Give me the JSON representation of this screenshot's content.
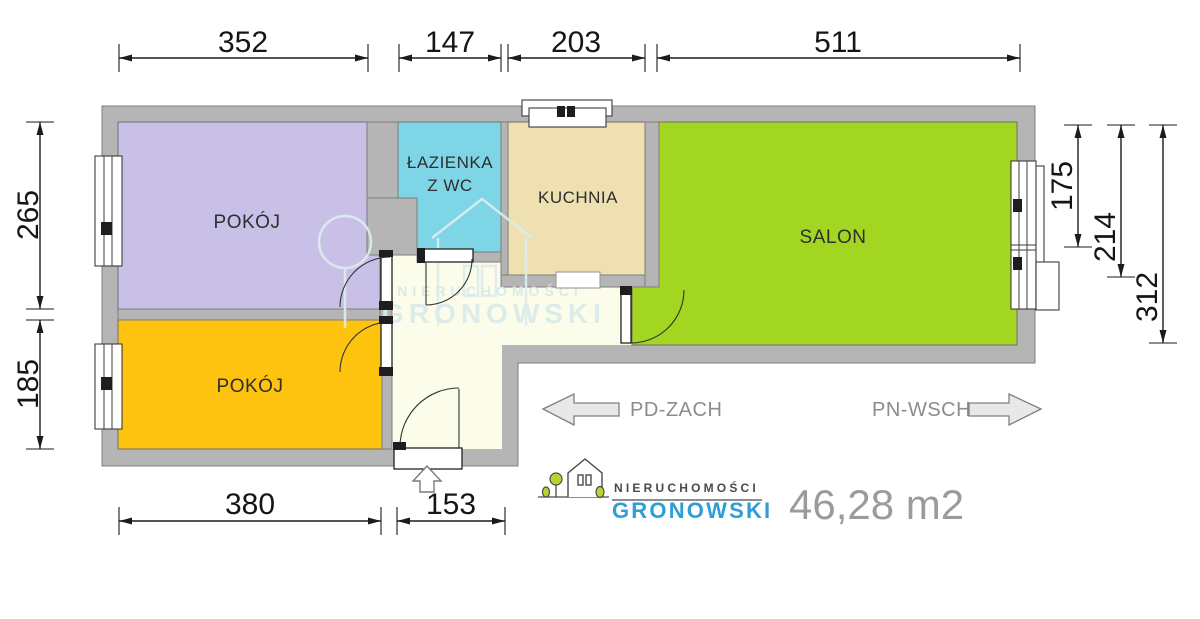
{
  "rooms": {
    "pokoj1": "POKÓJ",
    "pokoj2": "POKÓJ",
    "lazienka_line1": "ŁAZIENKA",
    "lazienka_line2": "Z WC",
    "kuchnia": "KUCHNIA",
    "salon": "SALON"
  },
  "dims": {
    "top": [
      "352",
      "147",
      "203",
      "511"
    ],
    "left": [
      "265",
      "185"
    ],
    "right": [
      "175",
      "214",
      "312"
    ],
    "bottom": [
      "380",
      "153"
    ]
  },
  "compass": {
    "west": "PD-ZACH",
    "east": "PN-WSCH"
  },
  "branding": {
    "name_top": "NIERUCHOMOŚCI",
    "name_bottom": "GRONOWSKI",
    "area": "46,28 m2",
    "blue": "#2e9fd6",
    "area_gray": "#9b9b9b"
  },
  "watermark": {
    "top": "NIERUCHOMOŚCI",
    "bottom": "GRONOWSKI"
  },
  "colors": {
    "wall": "#b5b5b5",
    "hall": "#fbfce9",
    "pokoj1": "#c9c0e7",
    "pokoj2": "#fdc30e",
    "lazienka": "#7ed5e6",
    "kuchnia": "#eee0b1",
    "salon": "#a2d620"
  }
}
